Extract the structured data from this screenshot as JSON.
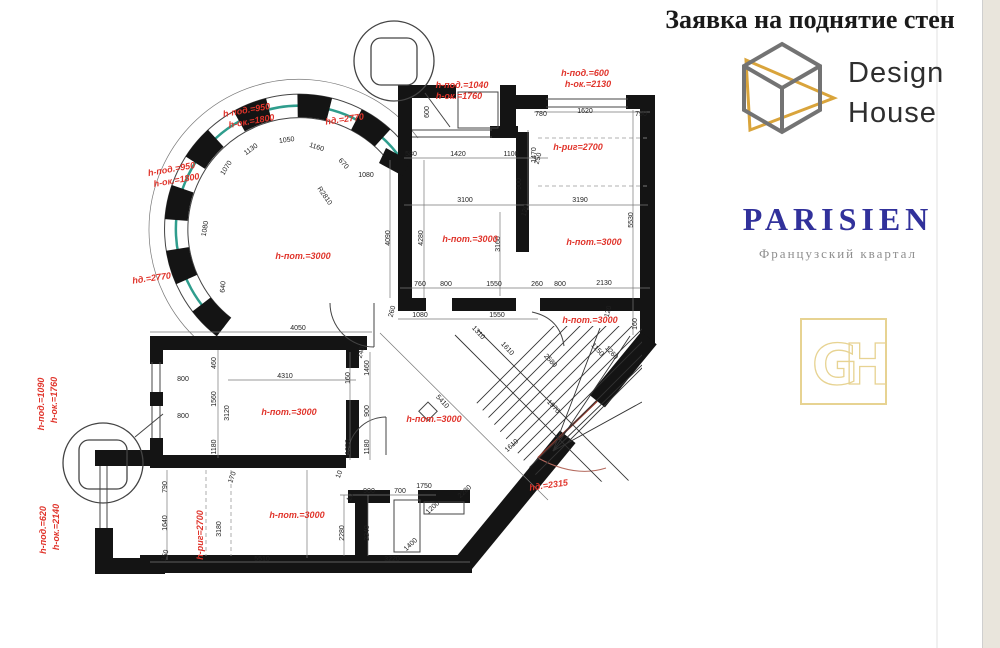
{
  "header": {
    "title": "Заявка на поднятие стен"
  },
  "branding": {
    "design_house": {
      "name_line1": "Design",
      "name_line2": "House"
    },
    "parisien": {
      "name": "PARISIEN",
      "subtitle": "Французский квартал"
    },
    "monogram": {
      "letters": "GH"
    }
  },
  "colors": {
    "annotation_red": "#e0342b",
    "wall_black": "#141414",
    "window_teal": "#2f9d8d",
    "parisien_navy": "#31319b",
    "cube_gray": "#737373",
    "accent_gold": "#d9a43b",
    "monogram_gold": "#e7d392"
  },
  "plan": {
    "annotations": [
      {
        "t": "h-под.=950",
        "x": 247,
        "y": 113,
        "r": -10
      },
      {
        "t": "h-ок.=1800",
        "x": 252,
        "y": 124,
        "r": -10
      },
      {
        "t": "hд.=2770",
        "x": 345,
        "y": 122,
        "r": -8
      },
      {
        "t": "h-под.=950",
        "x": 172,
        "y": 172,
        "r": -10
      },
      {
        "t": "h-ок.=1800",
        "x": 177,
        "y": 183,
        "r": -10
      },
      {
        "t": "hд.=2770",
        "x": 152,
        "y": 281,
        "r": -8
      },
      {
        "t": "h-пот.=3000",
        "x": 303,
        "y": 259,
        "r": 0
      },
      {
        "t": "h-под.=1040",
        "x": 462,
        "y": 88,
        "r": 0
      },
      {
        "t": "h-ок.=1760",
        "x": 459,
        "y": 99,
        "r": 0
      },
      {
        "t": "h-под.=600",
        "x": 585,
        "y": 76,
        "r": 0
      },
      {
        "t": "h-ок.=2130",
        "x": 588,
        "y": 87,
        "r": 0
      },
      {
        "t": "h-риг=2700",
        "x": 578,
        "y": 150,
        "r": 0
      },
      {
        "t": "h-пот.=3000",
        "x": 470,
        "y": 242,
        "r": 0
      },
      {
        "t": "h-пот.=3000",
        "x": 594,
        "y": 245,
        "r": 0
      },
      {
        "t": "h-пот.=3000",
        "x": 590,
        "y": 323,
        "r": 0
      },
      {
        "t": "h-пот.=3000",
        "x": 289,
        "y": 415,
        "r": 0
      },
      {
        "t": "h-пот.=3000",
        "x": 434,
        "y": 422,
        "r": 0
      },
      {
        "t": "h-пот.=3000",
        "x": 297,
        "y": 518,
        "r": 0
      },
      {
        "t": "h-под.=1090",
        "x": 44,
        "y": 404,
        "r": -90
      },
      {
        "t": "h-ок.=1760",
        "x": 57,
        "y": 400,
        "r": -90
      },
      {
        "t": "h-под.=620",
        "x": 46,
        "y": 530,
        "r": -90
      },
      {
        "t": "h-ок.=2140",
        "x": 59,
        "y": 527,
        "r": -90
      },
      {
        "t": "h-риг=2700",
        "x": 203,
        "y": 535,
        "r": -90
      },
      {
        "t": "hд.=2315",
        "x": 549,
        "y": 488,
        "r": -8
      }
    ],
    "dimensions": [
      {
        "t": "780",
        "x": 541,
        "y": 116,
        "r": 0
      },
      {
        "t": "1620",
        "x": 585,
        "y": 113,
        "r": 0
      },
      {
        "t": "790",
        "x": 641,
        "y": 116,
        "r": 0
      },
      {
        "t": "1470",
        "x": 536,
        "y": 155,
        "r": -90
      },
      {
        "t": "5530",
        "x": 633,
        "y": 220,
        "r": -90
      },
      {
        "t": "3190",
        "x": 580,
        "y": 202,
        "r": 0
      },
      {
        "t": "120",
        "x": 527,
        "y": 211,
        "r": -75
      },
      {
        "t": "2130",
        "x": 604,
        "y": 285,
        "r": 0
      },
      {
        "t": "600",
        "x": 429,
        "y": 112,
        "r": -90
      },
      {
        "t": "580",
        "x": 411,
        "y": 156,
        "r": 0
      },
      {
        "t": "1420",
        "x": 458,
        "y": 156,
        "r": 0
      },
      {
        "t": "1100",
        "x": 511,
        "y": 156,
        "r": 0
      },
      {
        "t": "250",
        "x": 540,
        "y": 159,
        "r": -75
      },
      {
        "t": "900",
        "x": 521,
        "y": 184,
        "r": -90
      },
      {
        "t": "3100",
        "x": 465,
        "y": 202,
        "r": 0
      },
      {
        "t": "4280",
        "x": 423,
        "y": 238,
        "r": -90
      },
      {
        "t": "4090",
        "x": 390,
        "y": 238,
        "r": -90
      },
      {
        "t": "3160",
        "x": 500,
        "y": 244,
        "r": -90
      },
      {
        "t": "760",
        "x": 420,
        "y": 286,
        "r": 0
      },
      {
        "t": "800",
        "x": 446,
        "y": 286,
        "r": 0
      },
      {
        "t": "1550",
        "x": 494,
        "y": 286,
        "r": 0
      },
      {
        "t": "260",
        "x": 537,
        "y": 286,
        "r": 0
      },
      {
        "t": "800",
        "x": 560,
        "y": 286,
        "r": 0
      },
      {
        "t": "260",
        "x": 394,
        "y": 312,
        "r": -75
      },
      {
        "t": "1080",
        "x": 420,
        "y": 317,
        "r": 0
      },
      {
        "t": "1550",
        "x": 497,
        "y": 317,
        "r": 0
      },
      {
        "t": "1080",
        "x": 366,
        "y": 177,
        "r": 0
      },
      {
        "t": "1130",
        "x": 252,
        "y": 151,
        "r": -35
      },
      {
        "t": "1050",
        "x": 287,
        "y": 142,
        "r": -8
      },
      {
        "t": "1160",
        "x": 316,
        "y": 149,
        "r": 18
      },
      {
        "t": "670",
        "x": 342,
        "y": 165,
        "r": 48
      },
      {
        "t": "R2810",
        "x": 323,
        "y": 197,
        "r": 55
      },
      {
        "t": "1070",
        "x": 228,
        "y": 169,
        "r": -58
      },
      {
        "t": "1080",
        "x": 207,
        "y": 229,
        "r": -80
      },
      {
        "t": "640",
        "x": 225,
        "y": 287,
        "r": -85
      },
      {
        "t": "4050",
        "x": 298,
        "y": 330,
        "r": 0
      },
      {
        "t": "240",
        "x": 363,
        "y": 353,
        "r": -75
      },
      {
        "t": "460",
        "x": 216,
        "y": 363,
        "r": -90
      },
      {
        "t": "800",
        "x": 183,
        "y": 381,
        "r": 0
      },
      {
        "t": "1560",
        "x": 216,
        "y": 399,
        "r": -90
      },
      {
        "t": "800",
        "x": 183,
        "y": 418,
        "r": 0
      },
      {
        "t": "1180",
        "x": 216,
        "y": 447,
        "r": -90
      },
      {
        "t": "3120",
        "x": 229,
        "y": 413,
        "r": -90
      },
      {
        "t": "4310",
        "x": 285,
        "y": 378,
        "r": 0
      },
      {
        "t": "160",
        "x": 350,
        "y": 378,
        "r": -90
      },
      {
        "t": "1460",
        "x": 369,
        "y": 368,
        "r": -90
      },
      {
        "t": "900",
        "x": 369,
        "y": 411,
        "r": -90
      },
      {
        "t": "1050",
        "x": 350,
        "y": 447,
        "r": -90
      },
      {
        "t": "1180",
        "x": 369,
        "y": 447,
        "r": -90
      },
      {
        "t": "170",
        "x": 234,
        "y": 478,
        "r": -70
      },
      {
        "t": "10",
        "x": 341,
        "y": 475,
        "r": -70
      },
      {
        "t": "790",
        "x": 167,
        "y": 487,
        "r": -90
      },
      {
        "t": "1640",
        "x": 167,
        "y": 523,
        "r": -90
      },
      {
        "t": "150",
        "x": 167,
        "y": 556,
        "r": -75
      },
      {
        "t": "3180",
        "x": 221,
        "y": 529,
        "r": -90
      },
      {
        "t": "5510",
        "x": 262,
        "y": 561,
        "r": 0
      },
      {
        "t": "3220",
        "x": 392,
        "y": 561,
        "r": 0
      },
      {
        "t": "2280",
        "x": 344,
        "y": 533,
        "r": -90
      },
      {
        "t": "2240",
        "x": 369,
        "y": 533,
        "r": -90
      },
      {
        "t": "10",
        "x": 352,
        "y": 498,
        "r": -70
      },
      {
        "t": "900",
        "x": 369,
        "y": 493,
        "r": 0
      },
      {
        "t": "700",
        "x": 400,
        "y": 493,
        "r": 0
      },
      {
        "t": "1750",
        "x": 424,
        "y": 488,
        "r": 0
      },
      {
        "t": "5410",
        "x": 441,
        "y": 403,
        "r": 47
      },
      {
        "t": "2580",
        "x": 549,
        "y": 362,
        "r": 47
      },
      {
        "t": "1970",
        "x": 552,
        "y": 408,
        "r": 47
      },
      {
        "t": "1310",
        "x": 477,
        "y": 334,
        "r": 47
      },
      {
        "t": "1610",
        "x": 506,
        "y": 350,
        "r": 47
      },
      {
        "t": "1150",
        "x": 596,
        "y": 351,
        "r": 47
      },
      {
        "t": "1260",
        "x": 610,
        "y": 354,
        "r": 47
      },
      {
        "t": "120",
        "x": 610,
        "y": 312,
        "r": -75
      },
      {
        "t": "160",
        "x": 637,
        "y": 324,
        "r": -90
      },
      {
        "t": "1610",
        "x": 513,
        "y": 447,
        "r": -43
      },
      {
        "t": "2280",
        "x": 466,
        "y": 493,
        "r": -43
      },
      {
        "t": "1200",
        "x": 434,
        "y": 509,
        "r": -43
      },
      {
        "t": "1400",
        "x": 412,
        "y": 546,
        "r": -43
      }
    ]
  }
}
